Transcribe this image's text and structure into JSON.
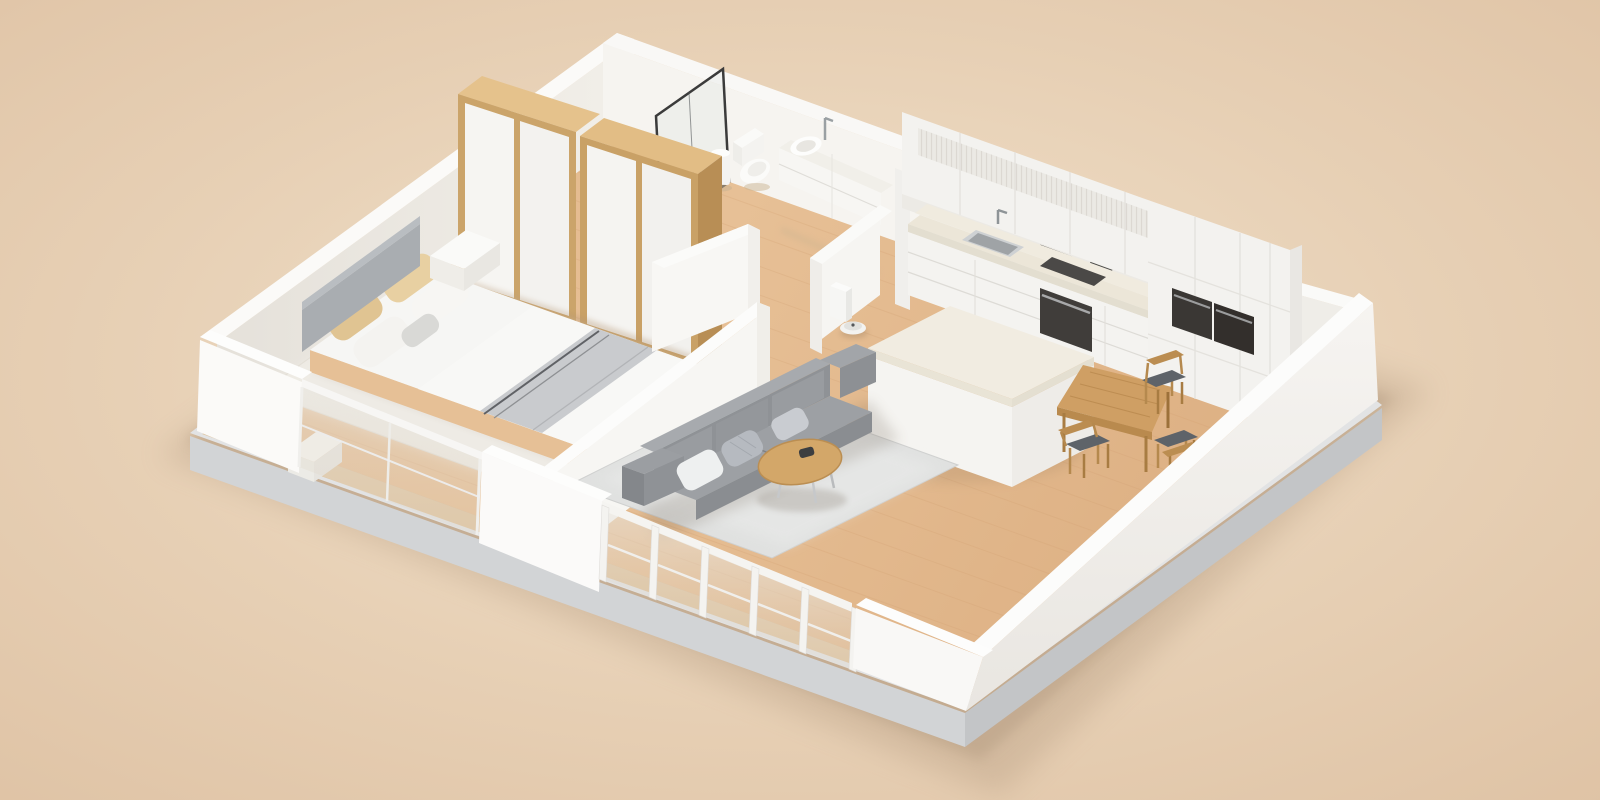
{
  "scene": {
    "kind": "isometric-3d-floorplan-render",
    "rooms": [
      {
        "name": "bedroom",
        "objects": [
          "double-bed",
          "gray-headboard",
          "beige-pillows",
          "white-pillows",
          "gray-folded-blanket",
          "nightstand-left",
          "nightstand-right",
          "cream-area-rug",
          "wardrobe-unit-1",
          "wardrobe-unit-2",
          "front-glass-wall"
        ]
      },
      {
        "name": "bathroom",
        "objects": [
          "glass-shower-screen",
          "pedal-bin",
          "toilet",
          "floating-vanity",
          "vessel-sink",
          "faucet"
        ]
      },
      {
        "name": "kitchen",
        "objects": [
          "fluted-upper-cabinets",
          "stone-countertop",
          "stainless-sink",
          "faucet",
          "cooktop",
          "built-in-oven",
          "tall-cabinets",
          "double-wall-ovens",
          "kitchen-island",
          "robot-vacuum",
          "robot-vacuum-dock"
        ]
      },
      {
        "name": "dining",
        "objects": [
          "wood-dining-table",
          "dining-chair-1",
          "dining-chair-2",
          "dining-chair-3"
        ]
      },
      {
        "name": "living-room",
        "objects": [
          "three-seat-gray-sofa",
          "throw-pillows",
          "round-coffee-table",
          "gray-area-rug",
          "floor-to-ceiling-windows"
        ]
      }
    ],
    "counts": {
      "dining_chairs": 3,
      "wardrobe_units": 2,
      "living_window_bays": 5,
      "wall_ovens": 2
    }
  },
  "palette": {
    "bg_inner": "#f0e1cb",
    "bg_outer": "#dfc4a6",
    "plinth_light": "#e2e3e4",
    "plinth_mid": "#d2d4d6",
    "plinth_dark": "#c3c5c7",
    "floor_wood": "#e3ba8d",
    "floor_slab": "#dfc5a2",
    "wall_bright": "#fbfaf8",
    "wall_face": "#f1eee8",
    "wall_shade": "#e7e3dc",
    "glass_tint": "#efece5",
    "rug_cream": "#ece9e2",
    "rug_gray": "#dfe0df",
    "sofa_gray": "#8f9296",
    "sofa_light": "#a7aaae",
    "bed_duvet": "#f6f6f4",
    "blanket_gray": "#c9cbce",
    "headboard_gray": "#a9adb1",
    "pillow_beige": "#e2c694",
    "wood_oak": "#cba46a",
    "wood_oak_light": "#e5c28c",
    "wood_table": "#cf9f64",
    "stone": "#f0ebdf",
    "appliance_dark": "#403d3a",
    "steel": "#9aa0a3",
    "shower_frame": "#3b3b3b"
  }
}
